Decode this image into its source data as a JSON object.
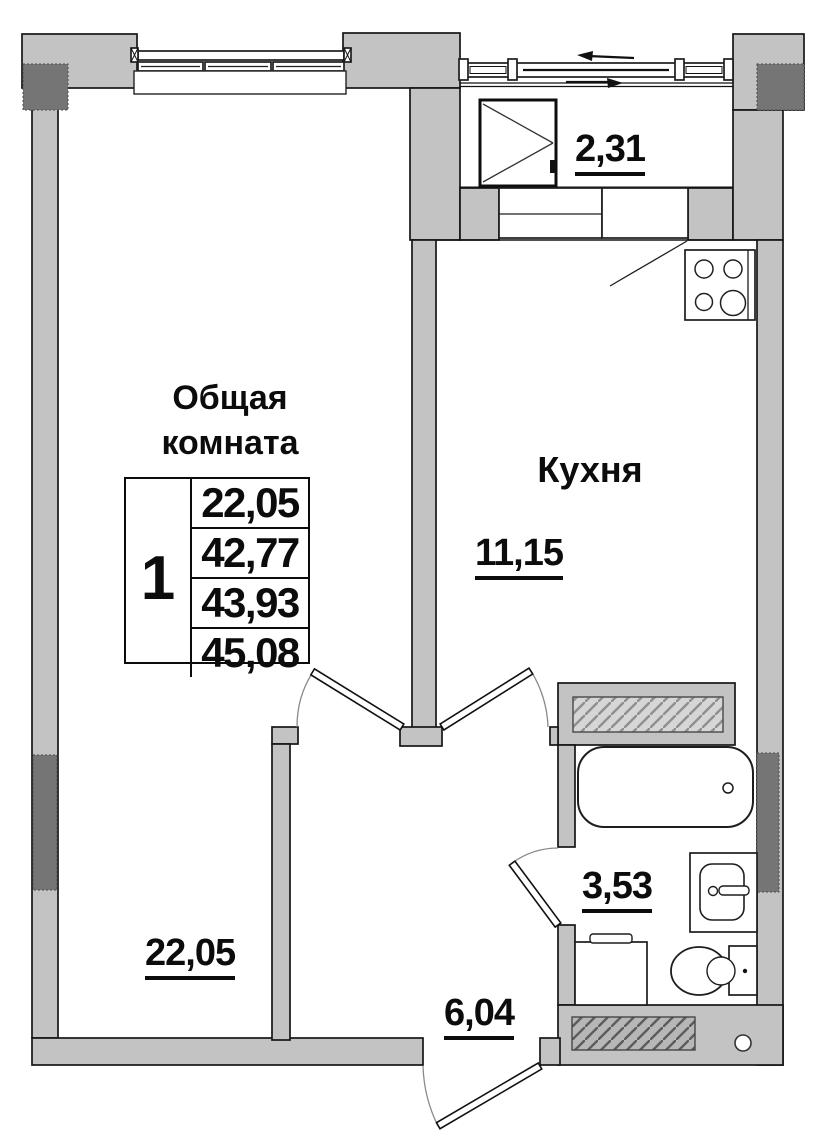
{
  "floor_plan": {
    "rooms": {
      "living_room": {
        "name_line1": "Общая",
        "name_line2": "комната",
        "area": "22,05"
      },
      "kitchen": {
        "name": "Кухня",
        "area": "11,15"
      },
      "balcony": {
        "area": "2,31"
      },
      "bathroom": {
        "area": "3,53"
      },
      "hallway": {
        "area": "6,04"
      }
    },
    "area_table": {
      "unit_number": "1",
      "values": [
        "22,05",
        "42,77",
        "43,93",
        "45,08"
      ]
    },
    "colors": {
      "wall_fill": "#c3c3c3",
      "dark_fill": "#757575",
      "line": "#161616"
    }
  }
}
